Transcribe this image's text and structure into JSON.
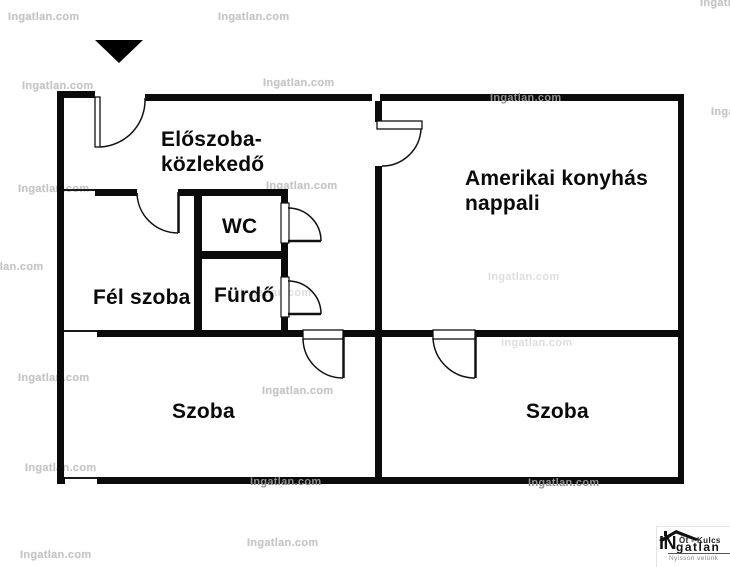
{
  "watermark": {
    "text": "Ingatlan.com"
  },
  "rooms": {
    "eloszoba": {
      "line1": "Előszoba-",
      "line2": "közlekedő"
    },
    "nappali": {
      "line1": "Amerikai konyhás",
      "line2": "nappali"
    },
    "wc": {
      "label": "WC"
    },
    "furdo": {
      "label": "Fürdő"
    },
    "fel_szoba": {
      "label": "Fél szoba"
    },
    "szoba_left": {
      "label": "Szoba"
    },
    "szoba_right": {
      "label": "Szoba"
    }
  },
  "logo": {
    "prefix": "IN",
    "keys_text": "Öt - Kulcs",
    "suffix": "gatlan",
    "tagline": "Nyisson velünk"
  },
  "colors": {
    "wall": "#0b0b0b",
    "watermark": "#c6c6c6",
    "watermark_on_wall": "#8f8f8f"
  }
}
